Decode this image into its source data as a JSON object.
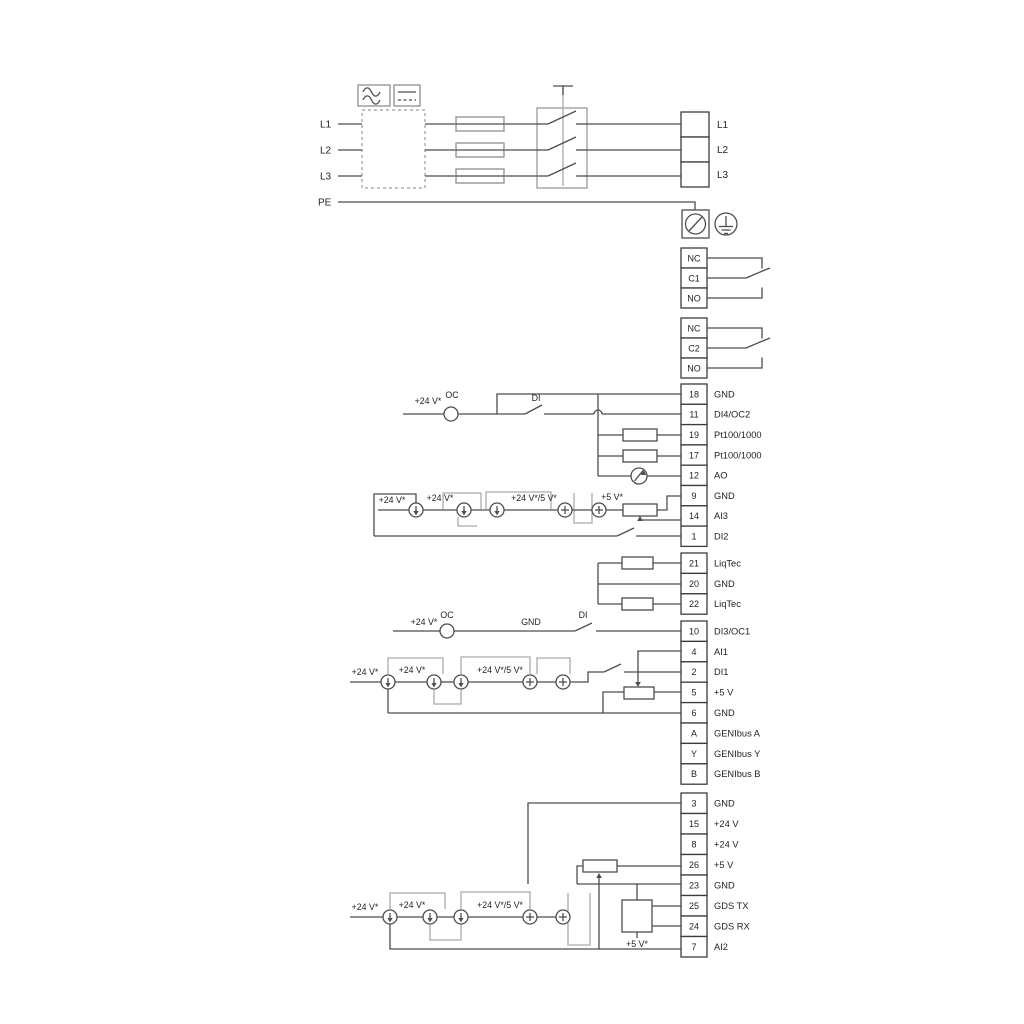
{
  "title": "Drive terminal wiring diagram",
  "colors": {
    "wire": "#4d4d4d",
    "gray_accent": "#ababab",
    "text": "#1f1f1f",
    "background": "#ffffff"
  },
  "power_input": {
    "labels": [
      "L1",
      "L2",
      "L3",
      "PE"
    ]
  },
  "mains_out": [
    "L1",
    "L2",
    "L3"
  ],
  "relays": [
    {
      "terminals": [
        "NC",
        "C1",
        "NO"
      ]
    },
    {
      "terminals": [
        "NC",
        "C2",
        "NO"
      ]
    }
  ],
  "terminal_blocks": {
    "block1": [
      [
        "18",
        "GND"
      ],
      [
        "11",
        "DI4/OC2"
      ],
      [
        "19",
        "Pt100/1000"
      ],
      [
        "17",
        "Pt100/1000"
      ],
      [
        "12",
        "AO"
      ],
      [
        "9",
        "GND"
      ],
      [
        "14",
        "AI3"
      ],
      [
        "1",
        "DI2"
      ]
    ],
    "liqtec": [
      [
        "21",
        "LiqTec"
      ],
      [
        "20",
        "GND"
      ],
      [
        "22",
        "LiqTec"
      ]
    ],
    "block2": [
      [
        "10",
        "DI3/OC1"
      ],
      [
        "4",
        "AI1"
      ],
      [
        "2",
        "DI1"
      ],
      [
        "5",
        "+5 V"
      ],
      [
        "6",
        "GND"
      ],
      [
        "A",
        "GENIbus A"
      ],
      [
        "Y",
        "GENIbus Y"
      ],
      [
        "B",
        "GENIbus B"
      ]
    ],
    "block3": [
      [
        "3",
        "GND"
      ],
      [
        "15",
        "+24 V"
      ],
      [
        "8",
        "+24 V"
      ],
      [
        "26",
        "+5 V"
      ],
      [
        "23",
        "GND"
      ],
      [
        "25",
        "GDS TX"
      ],
      [
        "24",
        "GDS RX"
      ],
      [
        "7",
        "AI2"
      ]
    ]
  },
  "wire_labels": {
    "v24": "+24 V*",
    "v24_5": "+24 V*/5 V*",
    "v5": "+5 V*",
    "oc": "OC",
    "di": "DI",
    "gnd": "GND"
  },
  "icons": [
    "ac-symbol-icon",
    "dc-symbol-icon",
    "screw-terminal-icon",
    "earth-ground-icon"
  ]
}
